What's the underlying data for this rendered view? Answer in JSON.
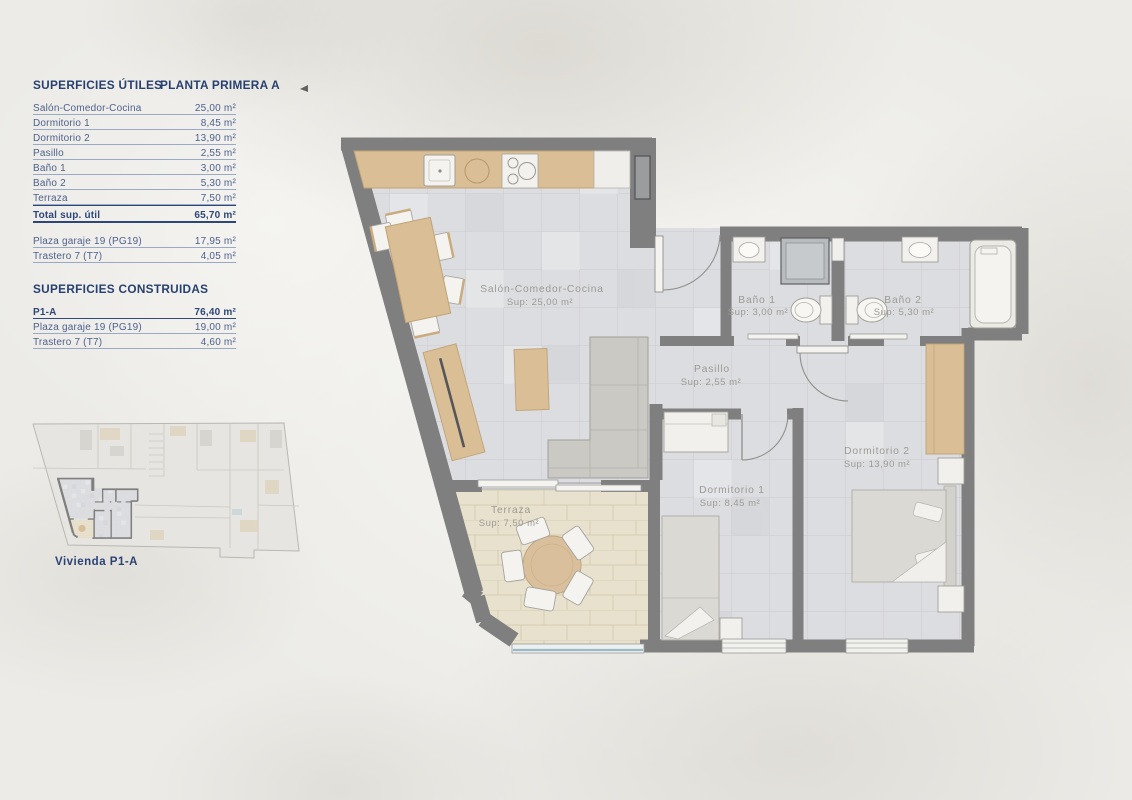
{
  "colors": {
    "wall_gray": "#7f7f7f",
    "navy_heading": "#27406f",
    "row_text_blue": "#4e618c",
    "plan_label_gray": "#9b9a95",
    "wood_tan": "#d9be96",
    "tile_gray": "#dcdde0",
    "terrace_beige": "#e8e1ce",
    "glass_blue": "#9db9c6"
  },
  "panel": {
    "utiles_title": "SUPERFICIES ÚTILES",
    "planta_title": "PLANTA PRIMERA A",
    "utiles_rows": [
      {
        "label": "Salón-Comedor-Cocina",
        "value": "25,00 m²"
      },
      {
        "label": "Dormitorio 1",
        "value": "8,45 m²"
      },
      {
        "label": "Dormitorio 2",
        "value": "13,90 m²"
      },
      {
        "label": "Pasillo",
        "value": "2,55 m²"
      },
      {
        "label": "Baño 1",
        "value": "3,00 m²"
      },
      {
        "label": "Baño 2",
        "value": "5,30 m²"
      },
      {
        "label": "Terraza",
        "value": "7,50 m²"
      }
    ],
    "total_row": {
      "label": "Total sup. útil",
      "value": "65,70 m²"
    },
    "annex_rows": [
      {
        "label": "Plaza garaje 19 (PG19)",
        "value": "17,95 m²"
      },
      {
        "label": "Trastero 7 (T7)",
        "value": "4,05 m²"
      }
    ],
    "construidas_title": "SUPERFICIES CONSTRUIDAS",
    "construidas_rows": [
      {
        "label": "P1-A",
        "value": "76,40 m²"
      },
      {
        "label": "Plaza garaje 19 (PG19)",
        "value": "19,00 m²"
      },
      {
        "label": "Trastero 7 (T7)",
        "value": "4,60 m²"
      }
    ]
  },
  "mini_plan": {
    "caption": "Vivienda P1-A"
  },
  "plan": {
    "rooms": [
      {
        "name": "Salón-Comedor-Cocina",
        "sup": "Sup: 25,00 m²"
      },
      {
        "name": "Baño 1",
        "sup": "Sup: 3,00 m²"
      },
      {
        "name": "Baño 2",
        "sup": "Sup: 5,30 m²"
      },
      {
        "name": "Pasillo",
        "sup": "Sup: 2,55 m²"
      },
      {
        "name": "Dormitorio 1",
        "sup": "Sup: 8,45 m²"
      },
      {
        "name": "Dormitorio 2",
        "sup": "Sup: 13,90 m²"
      },
      {
        "name": "Terraza",
        "sup": "Sup: 7,50 m²"
      }
    ]
  }
}
